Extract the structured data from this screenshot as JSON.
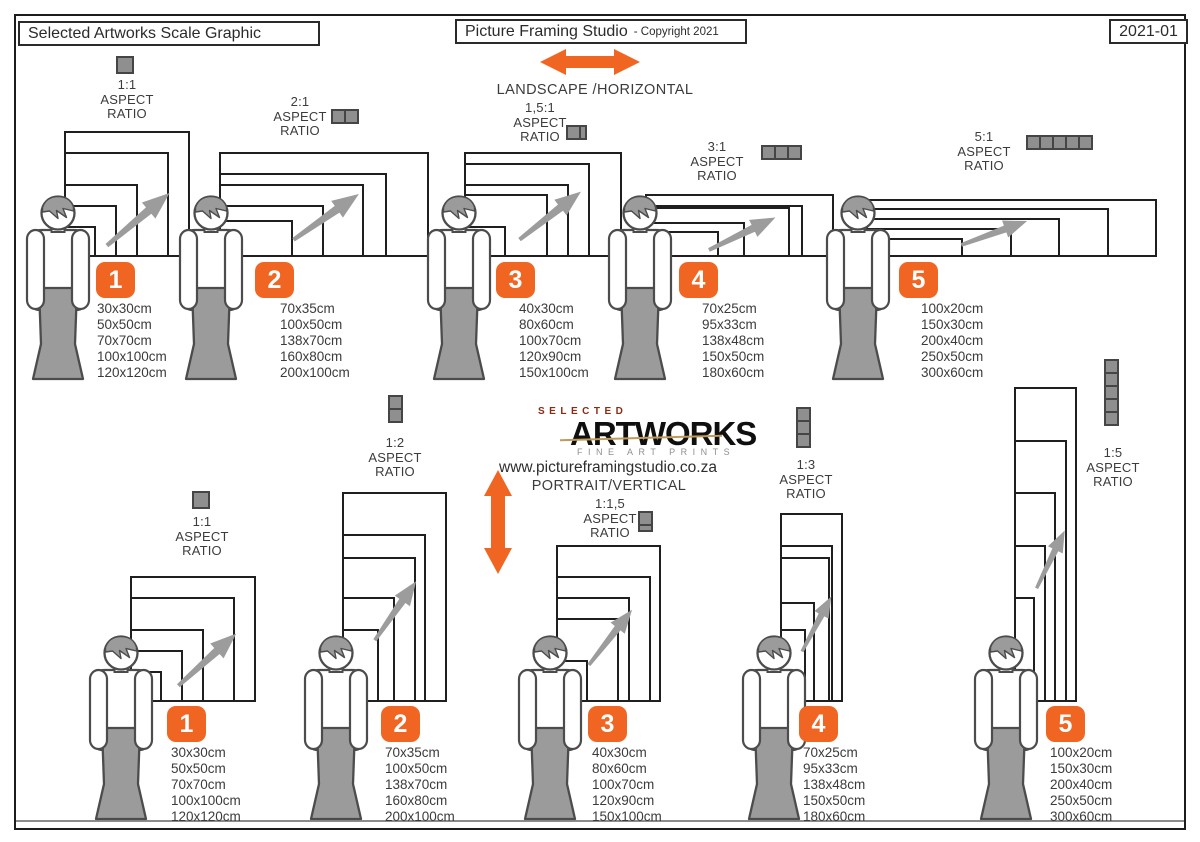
{
  "header": {
    "left_title": "Selected Artworks Scale Graphic",
    "center_title": "Picture Framing Studio",
    "center_suffix": "- Copyright 2021",
    "doc_number": "2021-01"
  },
  "labels": {
    "aspect": "ASPECT",
    "ratio": "RATIO"
  },
  "landscape": {
    "direction_label": "LANDSCAPE /HORIZONTAL",
    "groups": [
      {
        "number": "1",
        "ratio": "1:1",
        "icon_units": 1,
        "sizes": [
          "30x30cm",
          "50x50cm",
          "70x70cm",
          "100x100cm",
          "120x120cm"
        ]
      },
      {
        "number": "2",
        "ratio": "2:1",
        "icon_units": 2,
        "sizes": [
          "70x35cm",
          "100x50cm",
          "138x70cm",
          "160x80cm",
          "200x100cm"
        ]
      },
      {
        "number": "3",
        "ratio": "1,5:1",
        "icon_units": 1.5,
        "sizes": [
          "40x30cm",
          "80x60cm",
          "100x70cm",
          "120x90cm",
          "150x100cm"
        ]
      },
      {
        "number": "4",
        "ratio": "3:1",
        "icon_units": 3,
        "sizes": [
          "70x25cm",
          "95x33cm",
          "138x48cm",
          "150x50cm",
          "180x60cm"
        ]
      },
      {
        "number": "5",
        "ratio": "5:1",
        "icon_units": 5,
        "sizes": [
          "100x20cm",
          "150x30cm",
          "200x40cm",
          "250x50cm",
          "300x60cm"
        ]
      }
    ]
  },
  "portrait": {
    "direction_label": "PORTRAIT/VERTICAL",
    "groups": [
      {
        "number": "1",
        "ratio": "1:1",
        "icon_units": 1,
        "sizes": [
          "30x30cm",
          "50x50cm",
          "70x70cm",
          "100x100cm",
          "120x120cm"
        ]
      },
      {
        "number": "2",
        "ratio": "1:2",
        "icon_units": 2,
        "sizes": [
          "70x35cm",
          "100x50cm",
          "138x70cm",
          "160x80cm",
          "200x100cm"
        ]
      },
      {
        "number": "3",
        "ratio": "1:1,5",
        "icon_units": 1.5,
        "sizes": [
          "40x30cm",
          "80x60cm",
          "100x70cm",
          "120x90cm",
          "150x100cm"
        ]
      },
      {
        "number": "4",
        "ratio": "1:3",
        "icon_units": 3,
        "sizes": [
          "70x25cm",
          "95x33cm",
          "138x48cm",
          "150x50cm",
          "180x60cm"
        ]
      },
      {
        "number": "5",
        "ratio": "1:5",
        "icon_units": 5,
        "sizes": [
          "100x20cm",
          "150x30cm",
          "200x40cm",
          "250x50cm",
          "300x60cm"
        ]
      }
    ]
  },
  "logo": {
    "top": "SELECTED",
    "main": "ARTWORKS",
    "sub": "FINE ART PRINTS",
    "website": "www.pictureframingstudio.co.za"
  },
  "icons": {
    "landscape_arrow": "double-horizontal-arrow",
    "portrait_arrow": "double-vertical-arrow",
    "scale_arrow": "diagonal-arrow",
    "person": "human-figure",
    "aspect_unit": "gray-square"
  },
  "colors": {
    "accent_orange": "#f16522",
    "frame_black": "#1f1f1f",
    "figure_gray": "#9b9b9b",
    "logo_red": "#8a2b12",
    "text_dark": "#3b3b3b"
  }
}
